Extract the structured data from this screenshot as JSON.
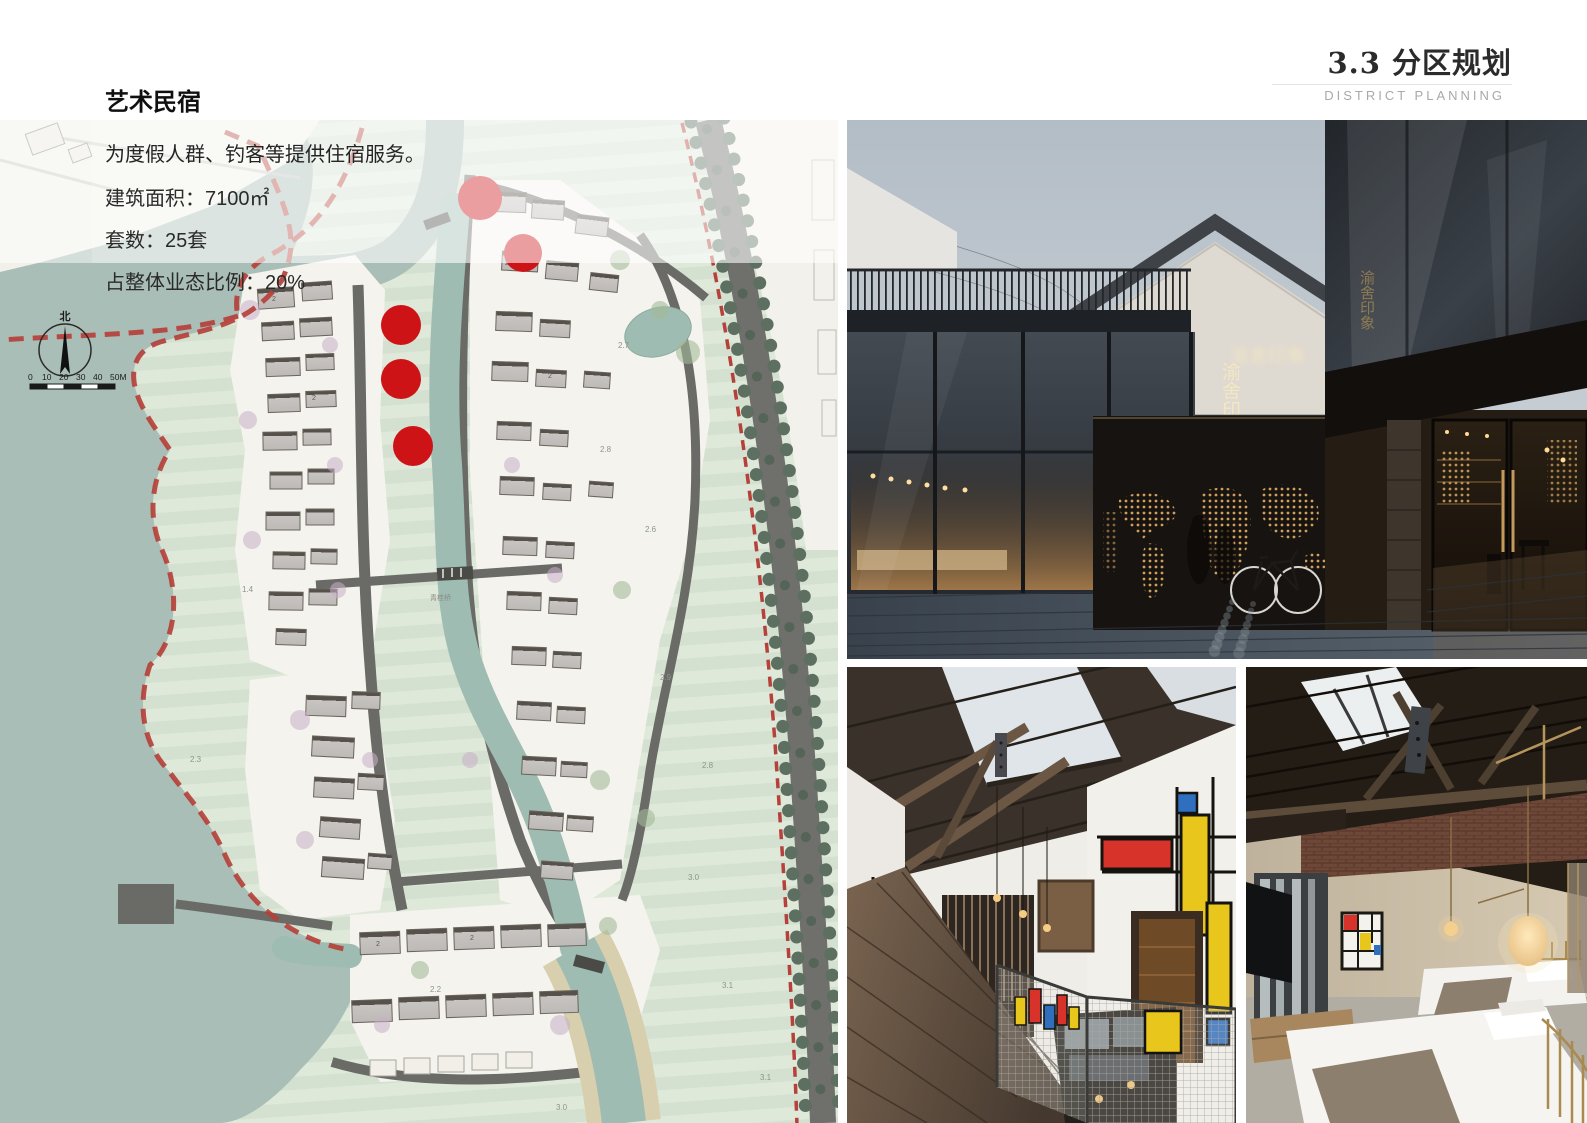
{
  "header": {
    "section_no_and_title": "3.3 分区规划",
    "subtitle_en": "DISTRICT PLANNING"
  },
  "info": {
    "heading": "艺术民宿",
    "description": "为度假人群、钓客等提供住宿服务。",
    "stats": [
      {
        "label": "建筑面积：",
        "value": "7100㎡"
      },
      {
        "label": "套数：",
        "value": "25套"
      },
      {
        "label": "占整体业态比例：",
        "value": "20%"
      }
    ]
  },
  "map": {
    "north_label": "北",
    "scale_labels": [
      "0",
      "10",
      "20",
      "30",
      "40",
      "50M"
    ],
    "bridge_label": "青桂桥",
    "floor_label": "2",
    "elevation_labels": [
      "2.7",
      "2.8",
      "2.6",
      "2.9",
      "2.8",
      "3.0",
      "3.1",
      "3.0",
      "2.2",
      "1.4",
      "2.3",
      "3.1"
    ],
    "markers": [
      {
        "x": 480,
        "y": 78,
        "r": 22
      },
      {
        "x": 523,
        "y": 133,
        "r": 19
      },
      {
        "x": 401,
        "y": 205,
        "r": 20
      },
      {
        "x": 401,
        "y": 259,
        "r": 20
      },
      {
        "x": 413,
        "y": 326,
        "r": 20
      }
    ],
    "colors": {
      "water": "#a9beb6",
      "field": "#d9e4d3",
      "parcel": "#f4f3ee",
      "building": "#c6c2bf",
      "road": "#6a6a67",
      "tree": "#5c6f60",
      "boundary": "#b5413a",
      "marker": "#ce1317"
    }
  },
  "photos": {
    "courtyard": {
      "sign_text": "渝舍印象"
    },
    "palette": {
      "sky": "#b8c2ca",
      "glass": "#2e3339",
      "warm_glow": "#c99a5e",
      "pavement": "#424c56",
      "timber": "#5f4f3f",
      "brick": "#6b4537",
      "linen": "#f3f1ed",
      "mondrian_red": "#d8332a",
      "mondrian_yellow": "#e8c61c",
      "mondrian_blue": "#2f6fbe"
    }
  }
}
